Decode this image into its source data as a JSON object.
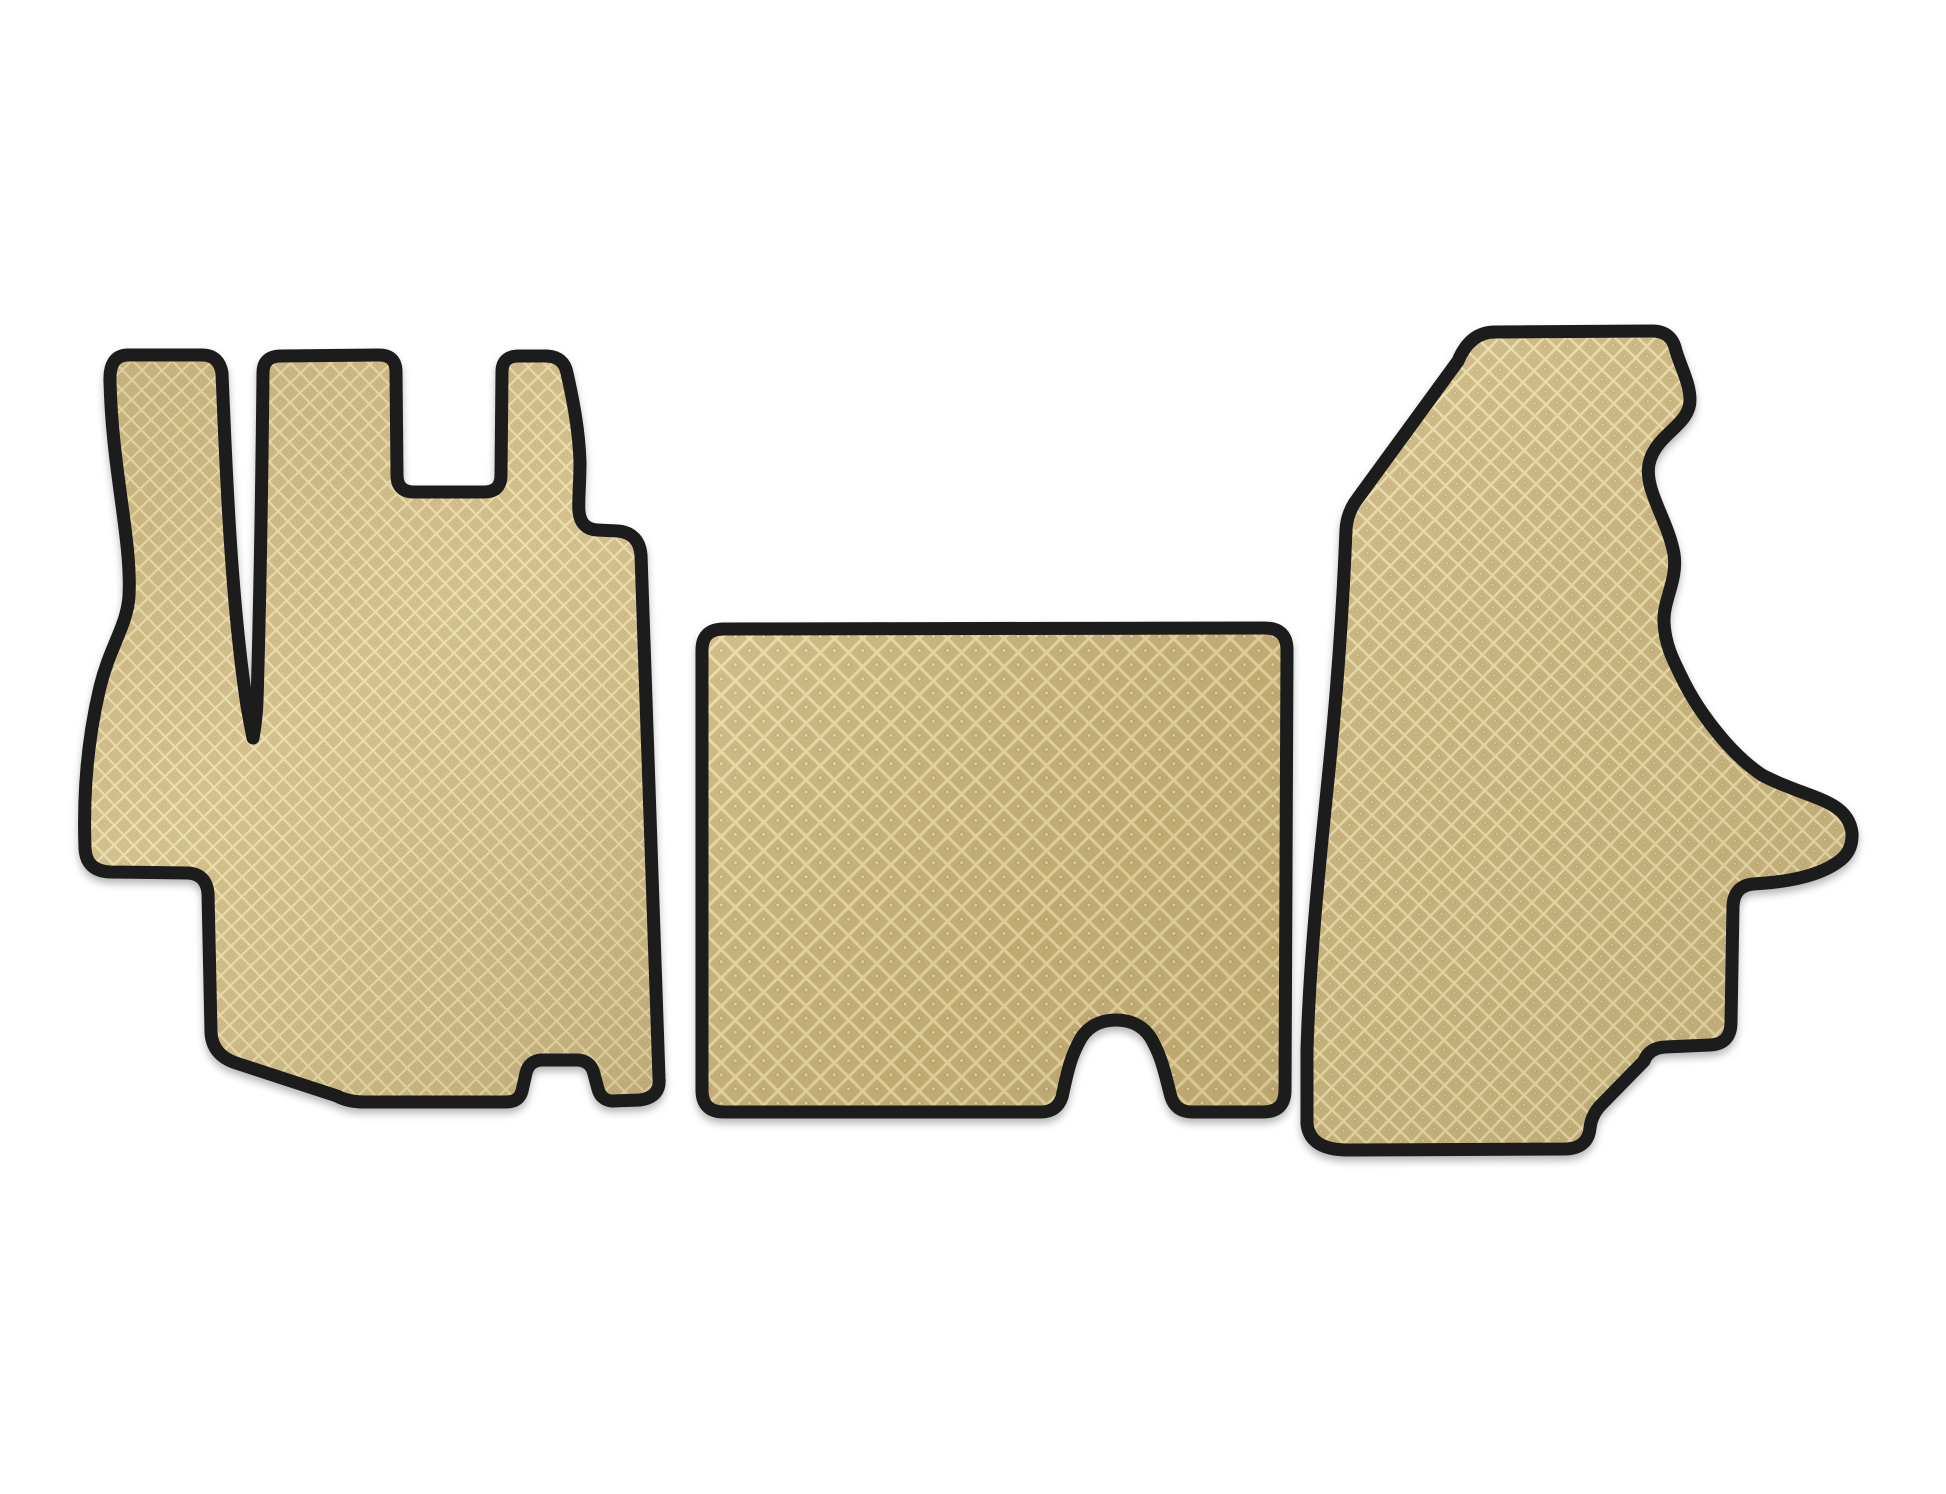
{
  "image": {
    "kind": "product-photo",
    "subject": "Set of 3 tailored EVA car floor mats, front cabin set",
    "piece_count": 3,
    "background_color": "#ffffff"
  },
  "mats": [
    {
      "id": "driver-side-mat",
      "position": "left",
      "appearance": "tall irregular mat with narrow side strip, two top fingers, square top notch, right-side step and bottom arch cutout",
      "surface_pattern": "diamond-rhombus EVA grid",
      "fill_color": "#cdb982",
      "grid_line_color": "#eadcaa",
      "trim_color": "#1b1b1b"
    },
    {
      "id": "center-tunnel-mat",
      "position": "center",
      "appearance": "rounded rectangle with arched cutout on bottom-right edge",
      "surface_pattern": "diamond-rhombus EVA grid",
      "fill_color": "#c9b47a",
      "grid_line_color": "#e9d9a4",
      "trim_color": "#1b1b1b"
    },
    {
      "id": "passenger-side-mat",
      "position": "right",
      "appearance": "tall mat with slanted top-left edge, wavy right edge, pointed side wing and stepped bottom-right corner",
      "surface_pattern": "diamond-rhombus EVA grid",
      "fill_color": "#cdb981",
      "grid_line_color": "#ecdfae",
      "trim_color": "#1b1b1b"
    }
  ],
  "colors": {
    "background": "#ffffff",
    "trim": "#1b1b1b",
    "mat_base_left": "#cdb982",
    "mat_base_center": "#c9b47a",
    "mat_base_right": "#cdb981",
    "grid_line_left": "#eadcaa",
    "grid_line_center": "#e9d9a4",
    "grid_line_right": "#ecdfae",
    "shadow": "rgba(0,0,0,0.28)"
  }
}
